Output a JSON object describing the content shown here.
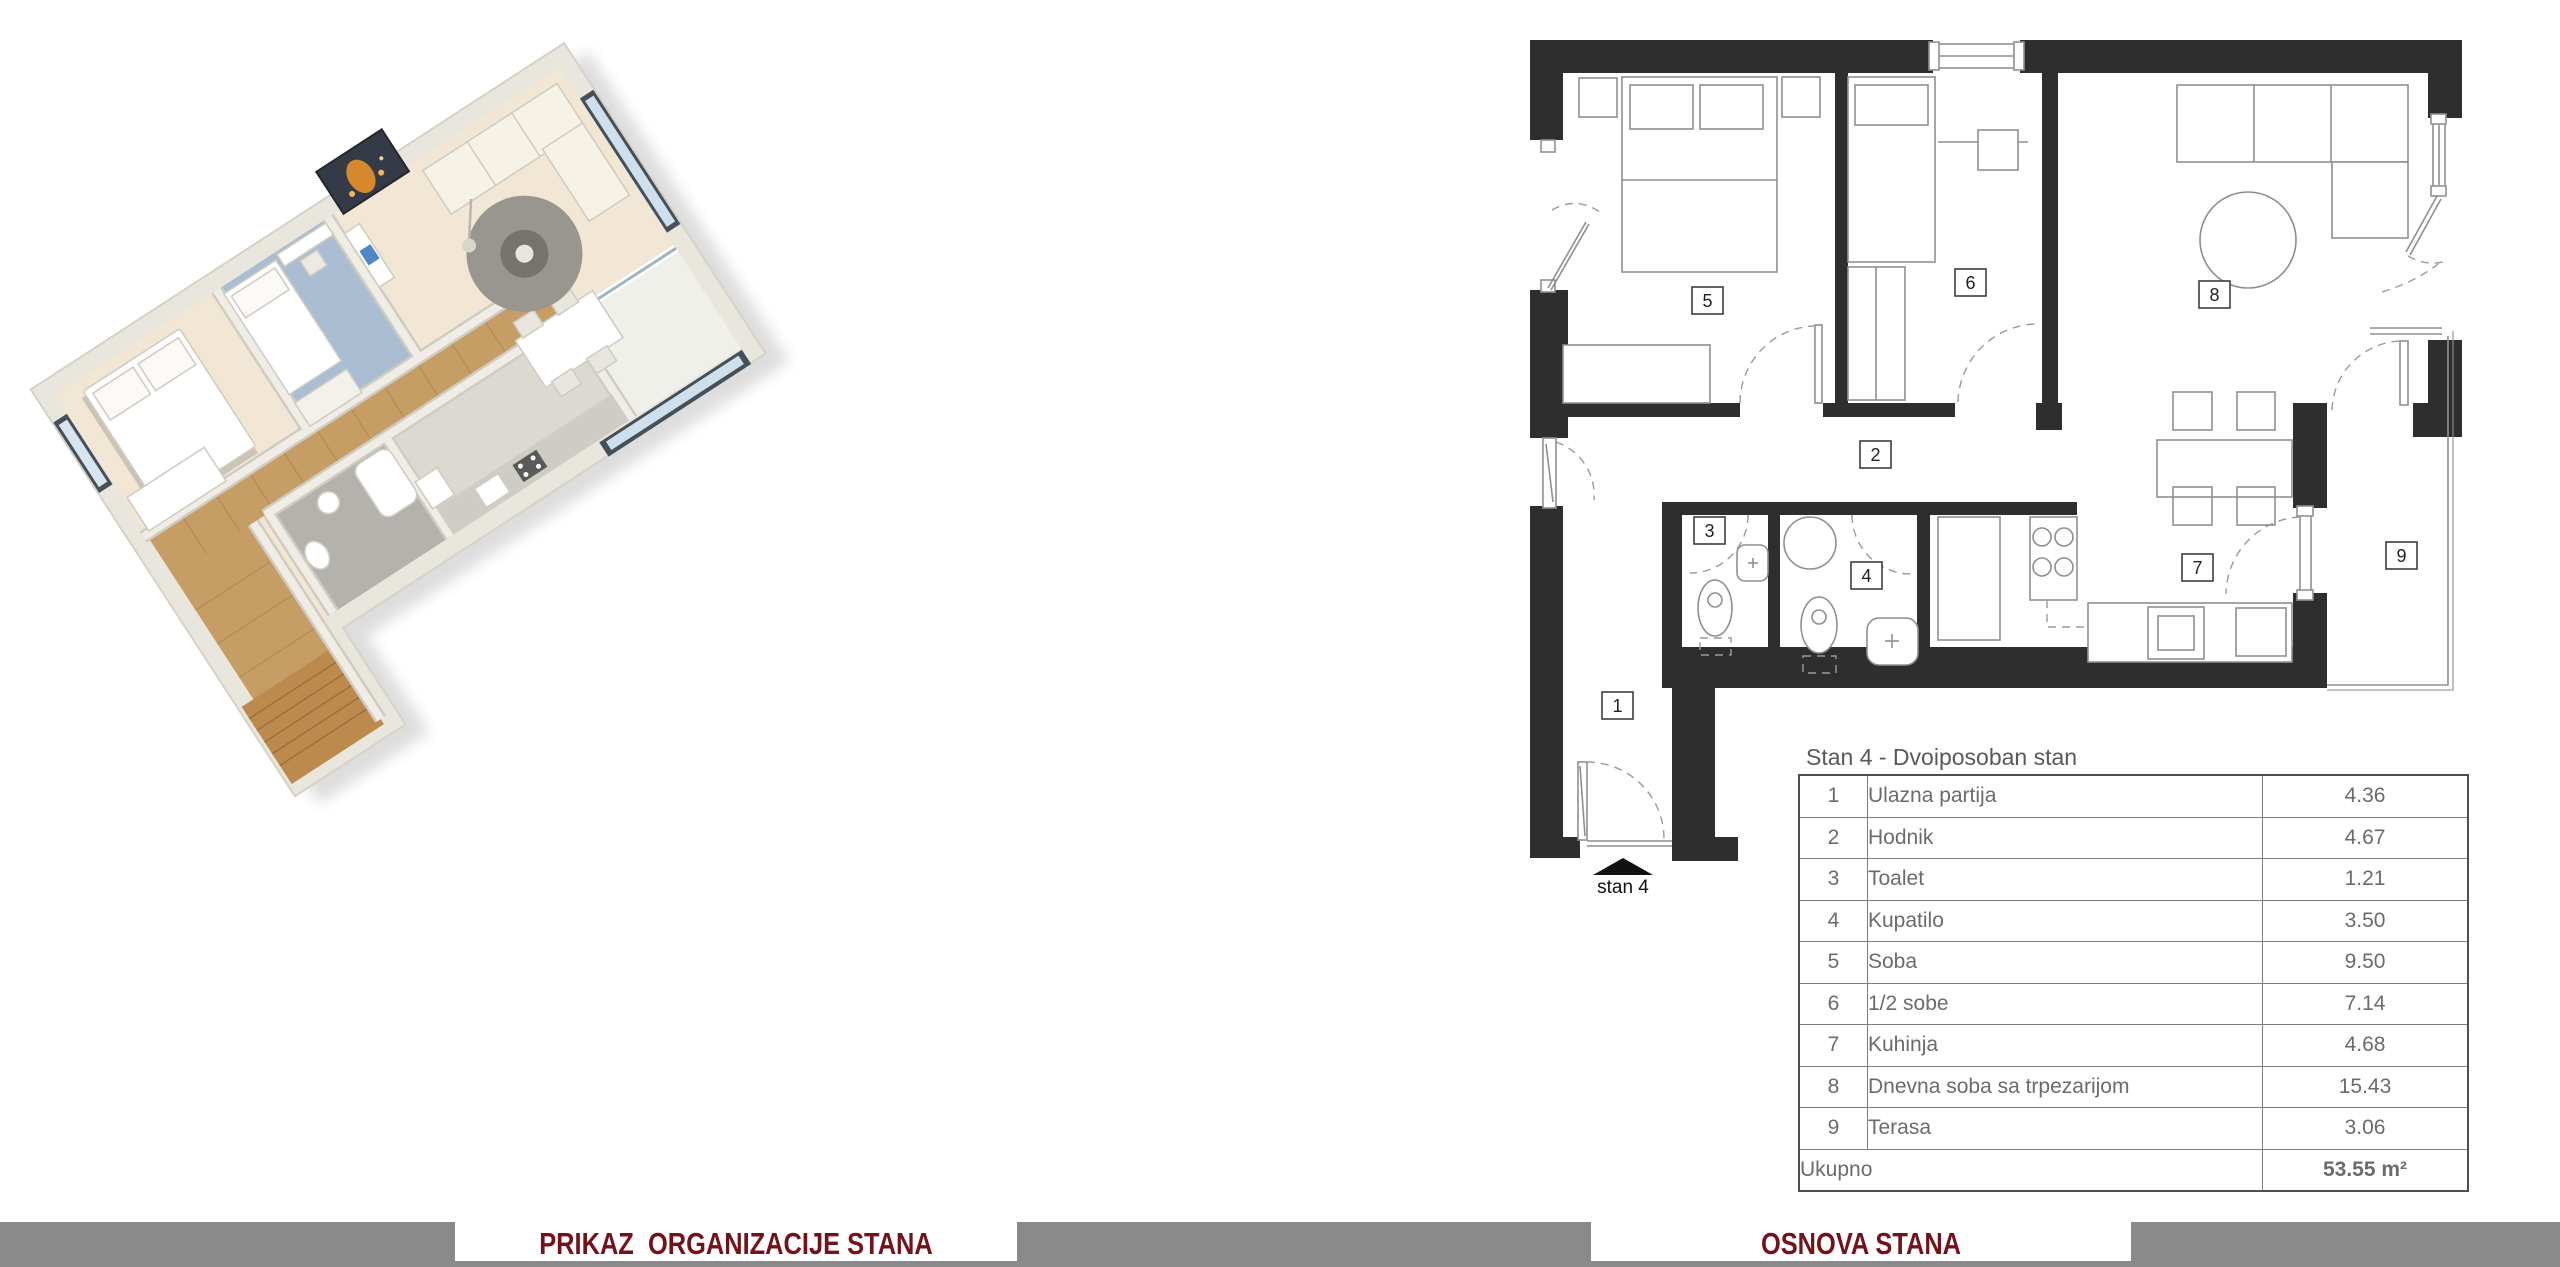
{
  "plan": {
    "room_labels": [
      {
        "num": "1"
      },
      {
        "num": "2"
      },
      {
        "num": "3"
      },
      {
        "num": "4"
      },
      {
        "num": "5"
      },
      {
        "num": "6"
      },
      {
        "num": "7"
      },
      {
        "num": "8"
      },
      {
        "num": "9"
      }
    ],
    "entrance_label": "stan 4"
  },
  "table": {
    "title": "Stan 4 - Dvoiposoban stan",
    "rows": [
      {
        "num": "1",
        "label": "Ulazna partija",
        "value": "4.36"
      },
      {
        "num": "2",
        "label": "Hodnik",
        "value": "4.67"
      },
      {
        "num": "3",
        "label": "Toalet",
        "value": "1.21"
      },
      {
        "num": "4",
        "label": "Kupatilo",
        "value": "3.50"
      },
      {
        "num": "5",
        "label": "Soba",
        "value": "9.50"
      },
      {
        "num": "6",
        "label": "1/2 sobe",
        "value": "7.14"
      },
      {
        "num": "7",
        "label": "Kuhinja",
        "value": "4.68"
      },
      {
        "num": "8",
        "label": "Dnevna soba sa trpezarijom",
        "value": "15.43"
      },
      {
        "num": "9",
        "label": "Terasa",
        "value": "3.06"
      }
    ],
    "total_label": "Ukupno",
    "total_value": "53.55 m²"
  },
  "footer": {
    "left_caption": "PRIKAZ  ORGANIZACIJE STANA",
    "right_caption": "OSNOVA STANA",
    "accent_color": "#74121a",
    "bar_color": "#8a8a8a"
  }
}
